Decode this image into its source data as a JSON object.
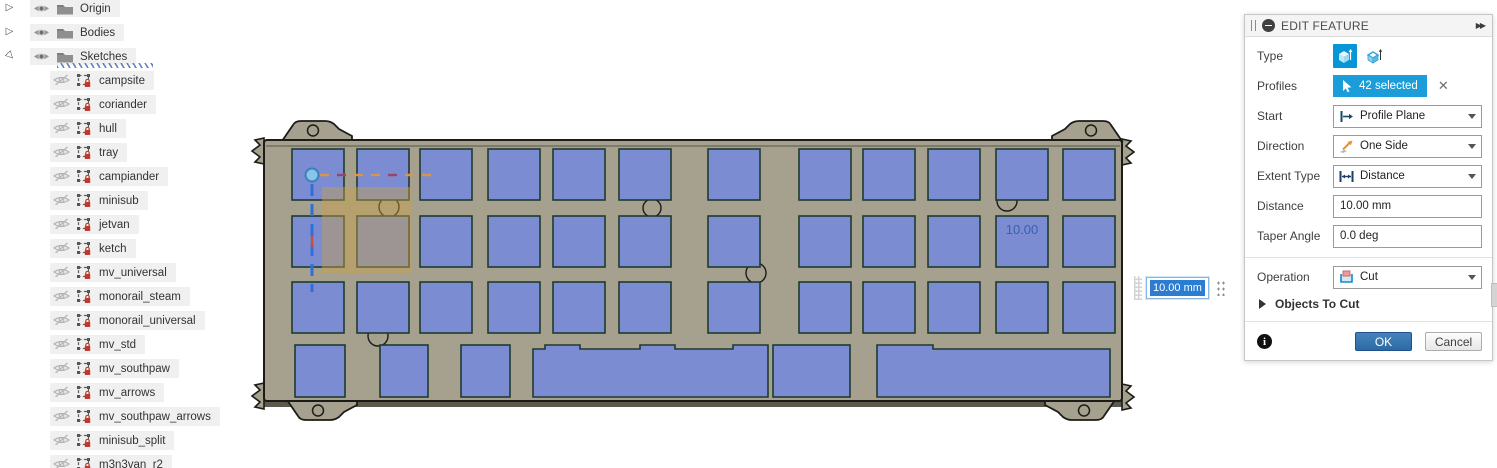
{
  "browser_tree": {
    "top_items": [
      {
        "label": "Origin",
        "expanded": false
      },
      {
        "label": "Bodies",
        "expanded": false
      },
      {
        "label": "Sketches",
        "expanded": true
      }
    ],
    "sketches": [
      "campsite",
      "coriander",
      "hull",
      "tray",
      "campiander",
      "minisub",
      "jetvan",
      "ketch",
      "mv_universal",
      "monorail_steam",
      "monorail_universal",
      "mv_std",
      "mv_southpaw",
      "mv_arrows",
      "mv_southpaw_arrows",
      "minisub_split",
      "m3n3van_r2"
    ]
  },
  "dialog": {
    "title": "EDIT FEATURE",
    "fields": [
      {
        "label": "Type"
      },
      {
        "label": "Profiles",
        "value": "42 selected"
      },
      {
        "label": "Start",
        "value": "Profile Plane"
      },
      {
        "label": "Direction",
        "value": "One Side"
      },
      {
        "label": "Extent Type",
        "value": "Distance"
      },
      {
        "label": "Distance",
        "value": "10.00 mm"
      },
      {
        "label": "Taper Angle",
        "value": "0.0 deg"
      },
      {
        "label": "Operation",
        "value": "Cut"
      }
    ],
    "section_label": "Objects To Cut",
    "ok_label": "OK",
    "cancel_label": "Cancel"
  },
  "canvas": {
    "dimension_label": "10.00",
    "floating_input_value": "10.00 mm",
    "plate": {
      "body": {
        "x": 264,
        "y": 140,
        "w": 858,
        "h": 261
      },
      "key_w": 52,
      "key_h": 51,
      "cols": [
        292,
        357,
        420,
        488,
        553,
        619,
        708,
        799,
        863,
        928,
        996,
        1063
      ],
      "row_tops": [
        149,
        216,
        282
      ],
      "bottom_row_y": 345,
      "bottom_row_h": 52,
      "bottom_keys": [
        {
          "x": 295,
          "w": 50,
          "type": "plain"
        },
        {
          "x": 380,
          "w": 48,
          "type": "plain"
        },
        {
          "x": 461,
          "w": 49,
          "type": "plain"
        },
        {
          "x": 533,
          "w": 235,
          "type": "bumps"
        },
        {
          "x": 773,
          "w": 77,
          "type": "plain"
        },
        {
          "x": 877,
          "w": 233,
          "type": "step"
        }
      ],
      "holes": [
        [
          389,
          207,
          10
        ],
        [
          652,
          208,
          9
        ],
        [
          1007,
          201,
          10
        ],
        [
          756,
          273,
          10
        ],
        [
          378,
          336,
          10
        ]
      ],
      "tabs": [
        {
          "cx": 317,
          "y": 141,
          "sx": 1,
          "sy": 1
        },
        {
          "cx": 1087,
          "y": 141,
          "sx": -1,
          "sy": 1
        },
        {
          "cx": 322,
          "y": 400,
          "sx": 1,
          "sy": -1
        },
        {
          "cx": 1080,
          "y": 400,
          "sx": -1,
          "sy": -1
        }
      ],
      "clips": [
        {
          "x": 264,
          "cy": 151,
          "s": 1
        },
        {
          "x": 264,
          "cy": 396,
          "s": 1
        },
        {
          "x": 1122,
          "cy": 152,
          "s": -1
        },
        {
          "x": 1122,
          "cy": 397,
          "s": -1
        }
      ],
      "origin": {
        "x": 312,
        "y": 175,
        "h_end": 432,
        "v_end": 292
      },
      "hover_overlay": {
        "x": 322,
        "y": 187,
        "w": 90,
        "h": 87
      },
      "dim_pos": {
        "x": 1022,
        "y": 234
      }
    },
    "colors": {
      "plate_fill": "#a6a18e",
      "plate_stroke": "#1b1b18",
      "plate_shadow": "#5d594e",
      "key_fill": "#7b8cd3",
      "key_stroke": "#1e3b2e",
      "overlay_fill": "rgba(199,160,72,0.45)",
      "dim_text": "#3a5fb0",
      "origin_dot_fill": "#88c4e8",
      "origin_dot_stroke": "#3a7fbc",
      "axis_h_orange": "#d9964a",
      "axis_h_purple": "#96466a",
      "axis_v_blue": "#2f6fd8",
      "axis_v_red": "#c05048"
    }
  },
  "icons": {
    "expander_collapsed": "▷",
    "expander_expanded": "▷",
    "double_arrow": "▶▶",
    "close_glyph": "✕",
    "info_glyph": "i"
  }
}
